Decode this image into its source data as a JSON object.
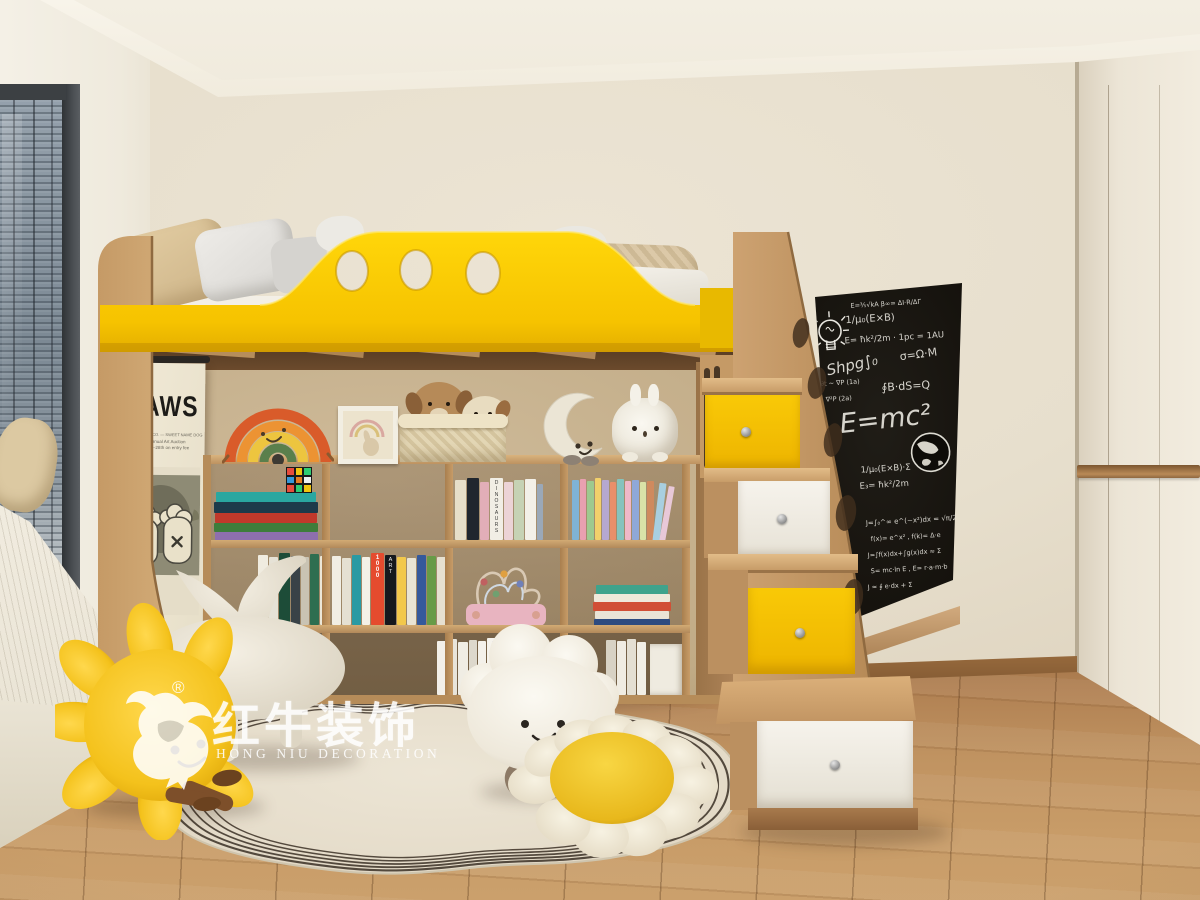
{
  "poster": {
    "title": "KAWS",
    "line1": "KING, WAYNE & CO. — SWEET NAME DOG",
    "line2": "2019 Annual Art Auction",
    "line3": "April 25th–28th on entry fee"
  },
  "blackboard": {
    "f1": "E=⅗√kA   β∞= ΔI·R/ΔΓ",
    "f2": "1/μ₀(E×B)",
    "f3": "E= ħk²/2m · 1pc = 1AU",
    "f4": "Shpg∫₀",
    "f5": "σ=Ω·M",
    "f6": "∮B·dS=Q",
    "f7": "∂P/∂t ~ ∇P   (1a)",
    "f8": "P ~ ∇²P   (2a)",
    "f9": "E=mc²",
    "f10": "1/μ₀(E×B)·Σ",
    "f11": "E₃= ħk²/2m",
    "f12": "J=∫₀^∞ e^(−x²)dx = √π/2",
    "f13": "f(x)= e^x² ,  f(k)= Δ·e",
    "f14": "J=∫f(x)dx+∫g(x)dx ≈ Σ",
    "f15": "S= mc·ln E ,  E= r·a·m·b",
    "f16": "J ≈ ∮ e·dx + Σ"
  },
  "books": {
    "dinosaurs": "DINOSAURS",
    "thousand": "1000",
    "art": "ART",
    "the": "THE"
  },
  "watermark": {
    "reg": "®",
    "brand_cn": "红牛装饰",
    "brand_en": "HONG NIU DECORATION"
  },
  "palette": {
    "accent_yellow": "#f7c600",
    "wood_light": "#c99e6b",
    "wall": "#e9e1d1",
    "blackboard": "#17140f",
    "floor": "#b4865a",
    "rug": "#e8e0cf"
  }
}
